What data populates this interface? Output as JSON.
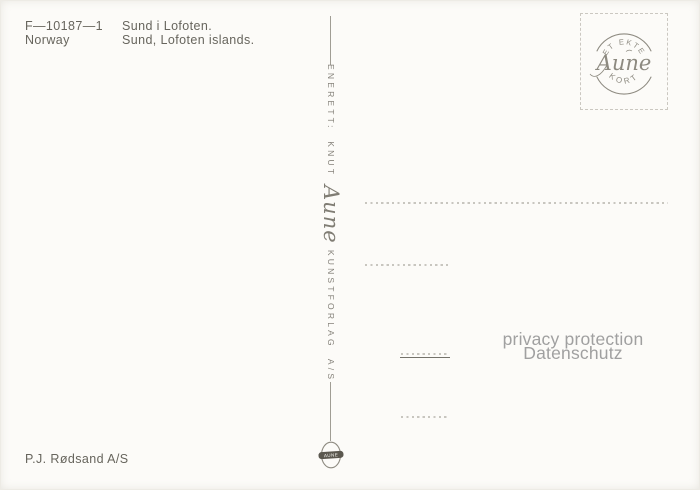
{
  "postcard": {
    "header": {
      "code": "F—10187—1",
      "country": "Norway",
      "title_local": "Sund i Lofoten.",
      "title_english": "Sund, Lofoten islands."
    },
    "spine": {
      "text_start": "ENERETT: KNUT",
      "script_name": "Aune",
      "text_end": "KUNSTFORLAG A/S"
    },
    "stamp_box": {
      "arc_top": "ET EKTE",
      "script_name": "Aune",
      "arc_bottom": "KORT"
    },
    "watermark": {
      "line1": "privacy protection",
      "line2": "Datenschutz"
    },
    "publisher": "P.J. Rødsand A/S",
    "emblem_label": "AUNE",
    "colors": {
      "background": "#fcfbf8",
      "ink": "#67655d",
      "faded_ink": "#85827a",
      "line_gray": "#c8c6bf",
      "watermark_gray": "#a0a0a0"
    }
  }
}
